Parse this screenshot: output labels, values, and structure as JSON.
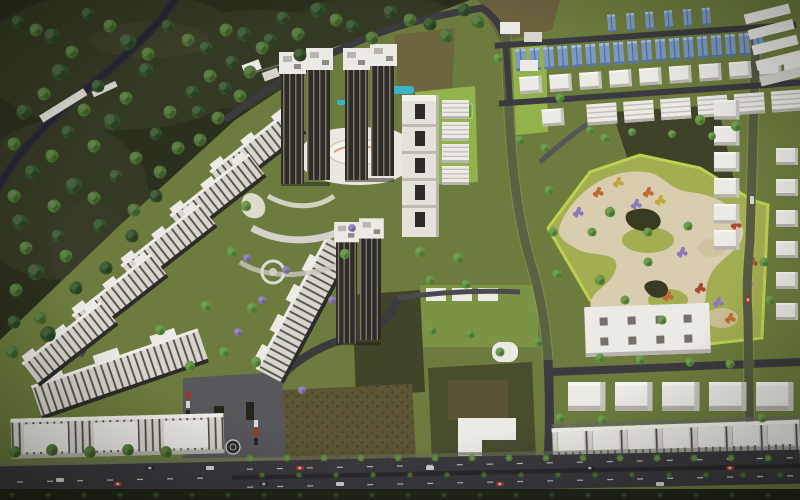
{
  "scene": {
    "title": "Aerial dusk 3D render of a township master plan",
    "view": "aerial-oblique",
    "lighting": "dusk",
    "regions": {
      "forest": "undeveloped scrub forest with canal road (top-left)",
      "towers": "high-rise residential tower pairs with white crowns (top-center)",
      "clubhouse": "wave-roof clubhouse with landscaped decks and pool",
      "apartment_chain": "diagonal chain of mid-rise apartment blocks (left)",
      "residential_slab": "mid-rise slab block running toward entrance (center)",
      "solar_row": "villa row with blue solar roofs (top-right)",
      "villa_plots": "grid of white villa / plot buildings (right)",
      "central_park": "organic landscaped park with flower beds (right-center)",
      "farmland": "dark cultivated farm patches (center & right)",
      "commercial": "large flat-roof commercial block with skylights (bottom-right)",
      "townhouses": "row of townhouses along main road (bottom-right)",
      "perimeter_slabs": "long apartment slabs along main road (bottom-left)",
      "entrance": "gated entrance plaza with parking and drop-off circle",
      "main_road": "tree-lined arterial road with median (bottom)"
    },
    "counts": {
      "tower_pairs": 3,
      "diagonal_apartment_blocks": 5,
      "perimeter_slab_blocks": 2,
      "solar_roof_panels": 18,
      "villa_shed_row": 6,
      "townhouse_units": 7
    }
  },
  "palette": {
    "forest_dark": "#2b2f1d",
    "forest_mid": "#3a4128",
    "tree_dark": "#33502a",
    "tree_green": "#4c7133",
    "tree_bright": "#619340",
    "lawn_olive": "#6d7c3e",
    "lawn_green": "#7c9245",
    "lawn_bright": "#94b24c",
    "park_green": "#a3ad52",
    "park_lime": "#bcd24f",
    "path_cream": "#dbcfb4",
    "sand": "#cfc1a0",
    "road": "#3b3b3f",
    "road_light": "#55555a",
    "asphalt_pale": "#6a6a6e",
    "white": "#eceae5",
    "white_dim": "#d6d4cd",
    "shadow": "#b5b3ac",
    "facade": "#2e2c28",
    "facade_tan": "#c9bda6",
    "stripe": "#504e47",
    "solar": "#7e9ac2",
    "solar_dark": "#4f6fa0",
    "teal": "#3ab4c6",
    "fl_orange": "#c06a33",
    "fl_purple": "#8a7ab8",
    "fl_red": "#a64733",
    "fl_yellow": "#c2a63e",
    "farm_dark": "#3f4128",
    "farm_brown": "#5c5635",
    "dirt": "#6b5f3e",
    "car_red": "#a83226",
    "car_white": "#d8d8d8",
    "car_dark": "#26262a",
    "median": "#2b2b2e",
    "wall": "#8e8a7c",
    "pond": "#383b22"
  }
}
